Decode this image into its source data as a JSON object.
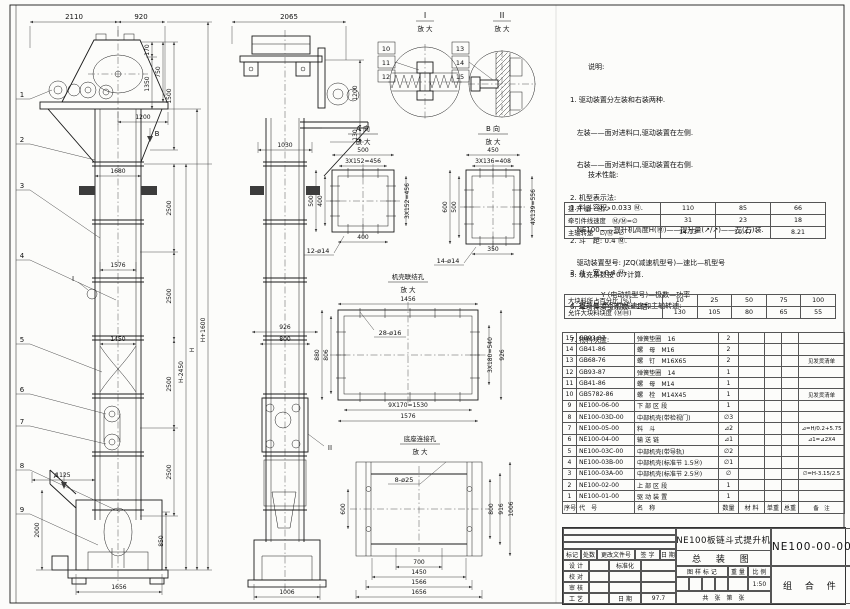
{
  "notes": {
    "title": "说明:",
    "lines": [
      "1. 驱动装置分左装和右装两种.",
      "   左装——面对进料口,驱动装置在左侧.",
      "   右装——面对进料口,驱动装置在右侧.",
      "2. 机型表示法:",
      "   NE100——提升机高度H(Ⓜ)——提升量(↗/↗)——左(右)装.",
      "   驱动装置型号: JZQ(减速机型号)—速比—机型号",
      "              Y (电动机型号)—极数—功率"
    ]
  },
  "specs": {
    "title": "技术性能:",
    "lines": [
      "1. 料斗容积: 0.033 Ⓜ.",
      "2. 斗　距: 0.4 Ⓜ.",
      "3. 斗　宽: 0.4 Ⓜ.",
      "4. 提升量,牵引件线速度和主轴转速:"
    ],
    "lines2": [
      "5. 填充系数按 0.7计算.",
      "6. 牵引件安全系数 >1倍.",
      "7. 物料块度:"
    ]
  },
  "capacity_table": {
    "rows": [
      [
        "提 升 量　Ⓜ/↗",
        "110",
        "85",
        "66"
      ],
      [
        "牵引件线速度　Ⓜ/Ⓜ=∅",
        "31",
        "23",
        "18"
      ],
      [
        "主轴转速　∅/Ⓜ=∅",
        "14.13",
        "10.47",
        "8.21"
      ]
    ]
  },
  "lump_table": {
    "rows": [
      [
        "大块料所占百分比 (%)",
        "10",
        "25",
        "50",
        "75",
        "100"
      ],
      [
        "允许大块料块度 (ⓂⓂ)",
        "130",
        "105",
        "80",
        "65",
        "55"
      ]
    ]
  },
  "bom": {
    "headers": [
      "序号",
      "代　号",
      "名　称",
      "数量",
      "材 料",
      "单重",
      "总重",
      "备　注"
    ],
    "rows": [
      [
        "15",
        "GB93-87",
        "弹簧垫圈　16",
        "2",
        "",
        "",
        "",
        ""
      ],
      [
        "14",
        "GB41-86",
        "螺　母　M16",
        "2",
        "",
        "",
        "",
        ""
      ],
      [
        "13",
        "GB68-76",
        "螺　钉　M16X65",
        "2",
        "",
        "",
        "",
        "见发货清单"
      ],
      [
        "12",
        "GB93-87",
        "弹簧垫圈　14",
        "1",
        "",
        "",
        "",
        ""
      ],
      [
        "11",
        "GB41-86",
        "螺　母　M14",
        "1",
        "",
        "",
        "",
        ""
      ],
      [
        "10",
        "GB5782-86",
        "螺　栓　M14X45",
        "1",
        "",
        "",
        "",
        "见发货清单"
      ],
      [
        "9",
        "NE100-06-00",
        "下 部 区 段",
        "1",
        "",
        "",
        "",
        ""
      ],
      [
        "8",
        "NE100-03D-00",
        "中部机壳(带检视门)",
        "∅3",
        "",
        "",
        "",
        ""
      ],
      [
        "7",
        "NE100-05-00",
        "料　斗",
        "⊿2",
        "",
        "",
        "",
        "⊿=H/0.2+5.75"
      ],
      [
        "6",
        "NE100-04-00",
        "输 送 链",
        "⊿1",
        "",
        "",
        "",
        "⊿1=⊿2X4"
      ],
      [
        "5",
        "NE100-03C-00",
        "中部机壳(带导轨)",
        "∅2",
        "",
        "",
        "",
        ""
      ],
      [
        "4",
        "NE100-03B-00",
        "中部机壳(标准节 1.5Ⓜ)",
        "∅1",
        "",
        "",
        "",
        ""
      ],
      [
        "3",
        "NE100-03A-00",
        "中部机壳(标准节 2.5Ⓜ)",
        "∅",
        "",
        "",
        "",
        "∅=H-3.15/2.5"
      ],
      [
        "2",
        "NE100-02-00",
        "上 部 区 段",
        "1",
        "",
        "",
        "",
        ""
      ],
      [
        "1",
        "NE100-01-00",
        "驱 动 装 置",
        "1",
        "",
        "",
        "",
        ""
      ]
    ]
  },
  "title_block": {
    "rev_labels": [
      "标记",
      "处数",
      "更改文件号",
      "签 字",
      "日 期"
    ],
    "staff": [
      "设 计",
      "校 对",
      "审 核",
      "工 艺"
    ],
    "std_label": "标准化",
    "date_label": "日 期",
    "date_value": "97.7",
    "stamp_label": "图 样 标 记",
    "weight_label": "重 量",
    "scale_label": "比 例",
    "scale_value": "1:50",
    "sheet_label": "共　张　第　张",
    "product": "NE100板链斗式提升机",
    "drawing_title": "总 装 图",
    "code": "NE100-00-00",
    "type": "组 合 件"
  },
  "dwg": {
    "front": {
      "w2110": "2110",
      "w920": "920",
      "d170": "170",
      "d1350": "1350",
      "d750": "750",
      "d1500": "1500",
      "w1200": "1200",
      "w1680": "1680",
      "w1576": "1576",
      "w1450": "1450",
      "d2500": "2500",
      "hm": "H-2450",
      "h": "H",
      "hp": "H+1600",
      "w1125": "1125",
      "d2000": "2000",
      "d850": "850",
      "w1656": "1656",
      "b1": "1",
      "b2": "2",
      "b3": "3",
      "b4": "4",
      "b5": "5",
      "b6": "6",
      "b7": "7",
      "b8": "8",
      "b9": "9",
      "va": "A",
      "vb": "B",
      "di": "I"
    },
    "side": {
      "w2065": "2065",
      "d1200": "1200",
      "d130": "130",
      "w1030": "1030",
      "w926": "926",
      "w800": "800",
      "w1006": "1006",
      "dii": "II"
    },
    "det1": {
      "t": "I",
      "s": "放 大",
      "b10": "10",
      "b11": "11",
      "b12": "12"
    },
    "det2": {
      "t": "II",
      "s": "放 大",
      "b13": "13",
      "b14": "14",
      "b15": "15"
    },
    "va": {
      "t": "A 向",
      "s": "放 大",
      "top": "500",
      "pitch": "3X152=456",
      "l1": "500",
      "l2": "400",
      "r": "3X152=456",
      "b": "400",
      "holes": "12-ø14"
    },
    "vb": {
      "t": "B 向",
      "s": "放 大",
      "top": "450",
      "pitch": "3X136=408",
      "l1": "600",
      "l2": "500",
      "r": "4X139=556",
      "b": "350",
      "holes": "14-ø14"
    },
    "cj": {
      "t": "机壳联结孔",
      "s": "放 大",
      "top": "1456",
      "holes": "28-ø16",
      "l1": "880",
      "l2": "806",
      "r1": "3X180=540",
      "r2": "926",
      "b1": "9X170=1530",
      "b2": "1576"
    },
    "bj": {
      "t": "底座连接孔",
      "s": "放 大",
      "holes": "8-ø25",
      "l": "600",
      "r1": "800",
      "r2": "916",
      "r3": "1006",
      "b1": "700",
      "b2": "1450",
      "b3": "1566",
      "b4": "1656"
    }
  }
}
